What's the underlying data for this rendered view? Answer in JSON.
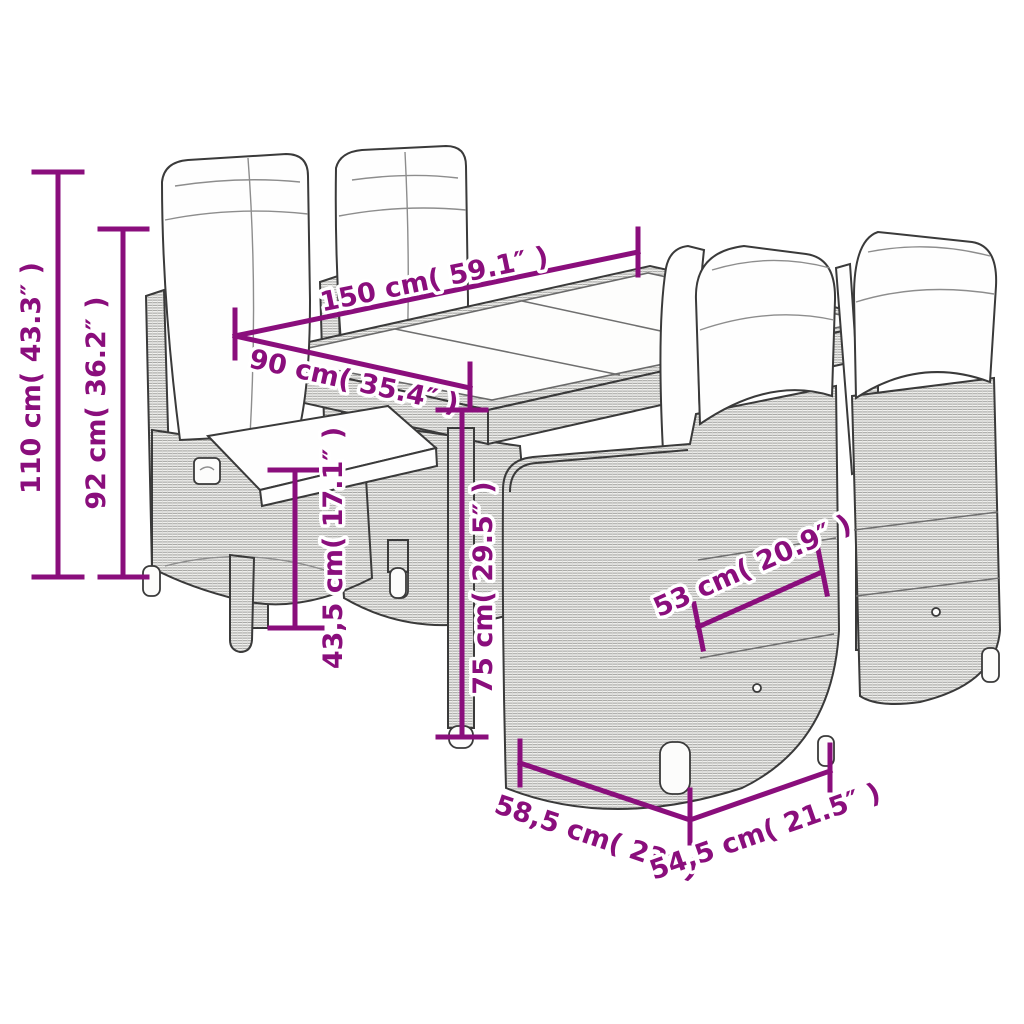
{
  "diagram": {
    "kind": "product-dimension-diagram",
    "subject": "garden dining set: glass-top poly rattan table with four reclining chairs and white cushions",
    "accent_color": "#8a0e7c",
    "drawing_ink_color": "#3a3a3a",
    "background_color": "#ffffff",
    "dimensions": {
      "total_height": {
        "label": "110 cm( 43.3″ )",
        "cm": "110",
        "inches": "43.3"
      },
      "backrest_height": {
        "label": "92 cm( 36.2″ )",
        "cm": "92",
        "inches": "36.2"
      },
      "table_length": {
        "label": "150 cm( 59.1″ )",
        "cm": "150",
        "inches": "59.1"
      },
      "table_width": {
        "label": "90 cm( 35.4″ )",
        "cm": "90",
        "inches": "35.4"
      },
      "seat_height": {
        "label": "43,5 cm( 17.1″ )",
        "cm": "43,5",
        "inches": "17.1"
      },
      "table_height": {
        "label": "75 cm( 29.5″ )",
        "cm": "75",
        "inches": "29.5"
      },
      "seat_width": {
        "label": "53 cm( 20.9″ )",
        "cm": "53",
        "inches": "20.9"
      },
      "chair_width": {
        "label": "58,5 cm( 23″ )",
        "cm": "58,5",
        "inches": "23"
      },
      "chair_depth": {
        "label": "54,5 cm( 21.5″ )",
        "cm": "54,5",
        "inches": "21.5"
      }
    }
  }
}
